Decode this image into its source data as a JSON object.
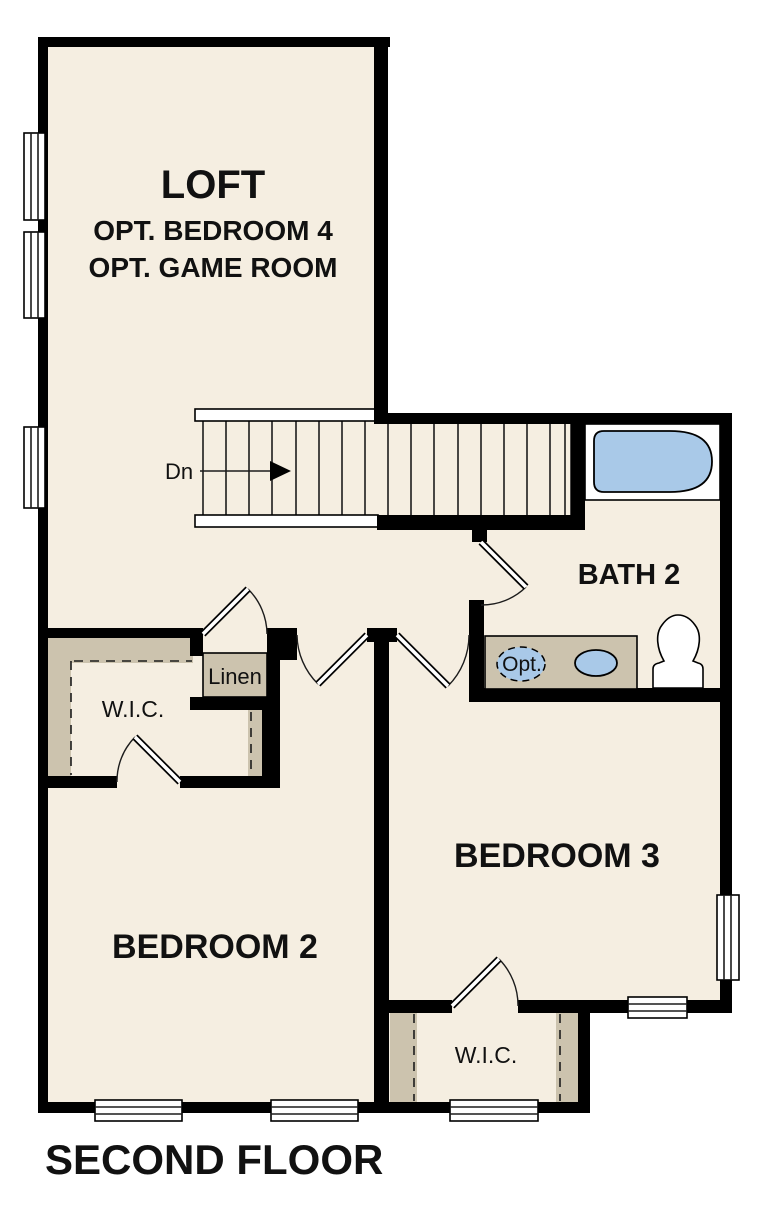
{
  "plan": {
    "title": "SECOND FLOOR",
    "loft": {
      "name": "LOFT",
      "opt1": "OPT. BEDROOM 4",
      "opt2": "OPT. GAME ROOM"
    },
    "stairs": {
      "direction": "Dn"
    },
    "bath": {
      "name": "BATH 2",
      "vanity_note": "Opt."
    },
    "linen": {
      "name": "Linen"
    },
    "wic_upper": {
      "name": "W.I.C."
    },
    "wic_lower": {
      "name": "W.I.C."
    },
    "bedroom2": {
      "name": "BEDROOM 2"
    },
    "bedroom3": {
      "name": "BEDROOM 3"
    }
  },
  "colors": {
    "wall": "#000000",
    "floor": "#F5EEE1",
    "shelf": "#CCC3AE",
    "fixture": "#A9C9E8",
    "outside": "#FFFFFF",
    "text": "#111111"
  }
}
